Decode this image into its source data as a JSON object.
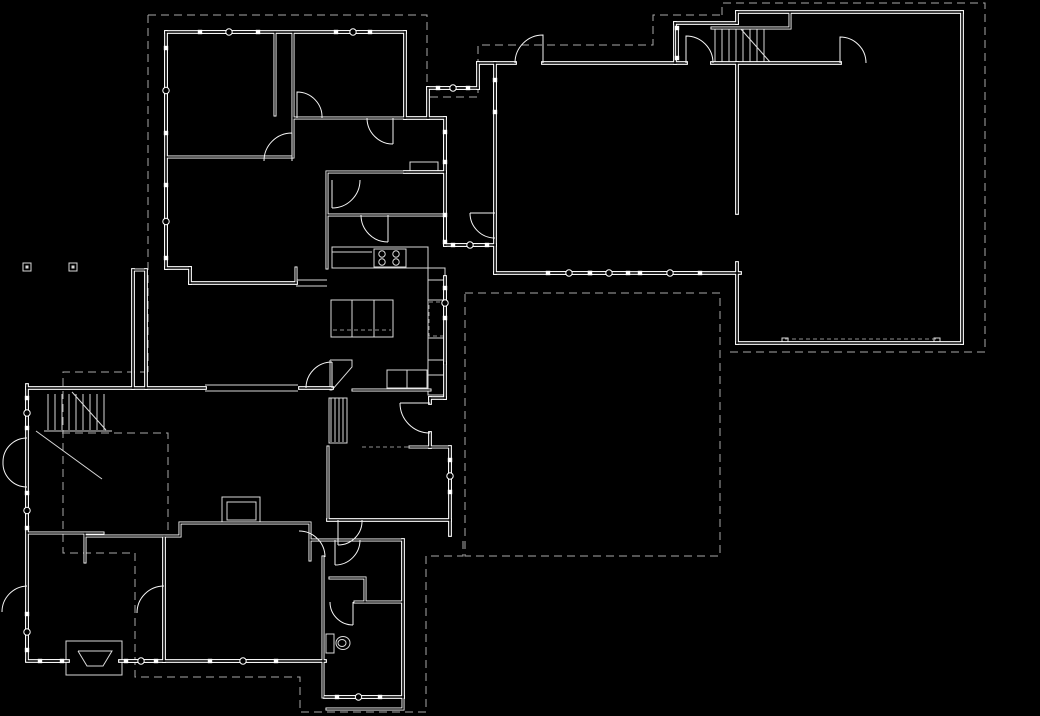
{
  "meta": {
    "canvas": {
      "w": 1040,
      "h": 716
    },
    "colors": {
      "background": "#000000",
      "wall": "#ffffff",
      "wall_core": "#000000",
      "thin": "#d9d9d9",
      "roof_dash": "#a8a8a8",
      "detail_dash": "#8f8f8f",
      "door": "#f5f5f5"
    },
    "drawing_type": "architectural-floor-plan"
  },
  "plan": {
    "walls_ext": [
      [
        166,
        32,
        405,
        32
      ],
      [
        166,
        32,
        166,
        268
      ],
      [
        405,
        32,
        405,
        118
      ],
      [
        405,
        118,
        445,
        118
      ],
      [
        445,
        118,
        445,
        245
      ],
      [
        405,
        172,
        445,
        172
      ],
      [
        445,
        245,
        495,
        245
      ],
      [
        495,
        63,
        495,
        273
      ],
      [
        478,
        63,
        515,
        63
      ],
      [
        543,
        63,
        686,
        63
      ],
      [
        712,
        63,
        840,
        63
      ],
      [
        478,
        63,
        478,
        88
      ],
      [
        428,
        88,
        478,
        88
      ],
      [
        428,
        88,
        428,
        118
      ],
      [
        495,
        273,
        740,
        273
      ],
      [
        737,
        63,
        737,
        213
      ],
      [
        737,
        263,
        737,
        343
      ],
      [
        737,
        12,
        962,
        12
      ],
      [
        962,
        12,
        962,
        343
      ],
      [
        737,
        343,
        962,
        343
      ],
      [
        675,
        23,
        737,
        23
      ],
      [
        675,
        23,
        675,
        63
      ],
      [
        737,
        12,
        737,
        23
      ],
      [
        166,
        268,
        190,
        268
      ],
      [
        190,
        268,
        190,
        283
      ],
      [
        190,
        283,
        296,
        283
      ],
      [
        27,
        388,
        205,
        388
      ],
      [
        300,
        388,
        332,
        388
      ],
      [
        27,
        385,
        27,
        660
      ],
      [
        27,
        661,
        68,
        661
      ],
      [
        120,
        661,
        164,
        661
      ],
      [
        164,
        661,
        325,
        661
      ],
      [
        164,
        538,
        164,
        661
      ],
      [
        325,
        697,
        403,
        697
      ],
      [
        403,
        540,
        403,
        697
      ],
      [
        430,
        433,
        430,
        447
      ],
      [
        450,
        447,
        450,
        535
      ],
      [
        328,
        520,
        450,
        520
      ],
      [
        445,
        277,
        445,
        363
      ],
      [
        445,
        363,
        445,
        398
      ],
      [
        430,
        398,
        445,
        398
      ],
      [
        430,
        398,
        430,
        403
      ],
      [
        133,
        270,
        133,
        388
      ],
      [
        146,
        270,
        146,
        388
      ]
    ],
    "walls_int": [
      [
        275,
        32,
        275,
        115
      ],
      [
        293,
        32,
        293,
        157
      ],
      [
        166,
        157,
        293,
        157
      ],
      [
        293,
        118,
        405,
        118
      ],
      [
        327,
        172,
        405,
        172
      ],
      [
        327,
        172,
        327,
        268
      ],
      [
        327,
        215,
        445,
        215
      ],
      [
        296,
        268,
        296,
        283
      ],
      [
        712,
        28,
        790,
        28
      ],
      [
        790,
        13,
        790,
        28
      ],
      [
        27,
        533,
        103,
        533
      ],
      [
        85,
        533,
        85,
        562
      ],
      [
        85,
        536,
        164,
        536
      ],
      [
        164,
        536,
        180,
        536
      ],
      [
        180,
        523,
        180,
        536
      ],
      [
        180,
        523,
        310,
        523
      ],
      [
        310,
        523,
        310,
        560
      ],
      [
        323,
        557,
        323,
        697
      ],
      [
        310,
        540,
        403,
        540
      ],
      [
        330,
        578,
        365,
        578
      ],
      [
        365,
        578,
        365,
        602
      ],
      [
        355,
        602,
        403,
        602
      ],
      [
        327,
        709,
        403,
        709
      ],
      [
        403,
        697,
        403,
        709
      ],
      [
        353,
        390,
        430,
        390
      ],
      [
        410,
        447,
        450,
        447
      ],
      [
        328,
        447,
        328,
        520
      ],
      [
        133,
        270,
        146,
        270
      ]
    ],
    "windows": [
      {
        "s": [
          200,
          32,
          258,
          32
        ],
        "c": true
      },
      {
        "s": [
          336,
          32,
          370,
          32
        ],
        "c": true
      },
      {
        "s": [
          166,
          48,
          166,
          133
        ],
        "c": true
      },
      {
        "s": [
          166,
          185,
          166,
          258
        ],
        "c": true
      },
      {
        "s": [
          438,
          88,
          468,
          88
        ],
        "c": true
      },
      {
        "s": [
          445,
          132,
          445,
          162
        ],
        "c": false
      },
      {
        "s": [
          445,
          215,
          445,
          242
        ],
        "c": false
      },
      {
        "s": [
          453,
          245,
          487,
          245
        ],
        "c": true
      },
      {
        "s": [
          495,
          80,
          495,
          112
        ],
        "c": false
      },
      {
        "s": [
          548,
          273,
          590,
          273
        ],
        "c": true
      },
      {
        "s": [
          590,
          273,
          628,
          273
        ],
        "c": true
      },
      {
        "s": [
          640,
          273,
          700,
          273
        ],
        "c": true
      },
      {
        "s": [
          445,
          288,
          445,
          318
        ],
        "c": true
      },
      {
        "s": [
          450,
          460,
          450,
          492
        ],
        "c": true
      },
      {
        "s": [
          27,
          398,
          27,
          428
        ],
        "c": true
      },
      {
        "s": [
          27,
          493,
          27,
          528
        ],
        "c": true
      },
      {
        "s": [
          27,
          614,
          27,
          650
        ],
        "c": true
      },
      {
        "s": [
          40,
          661,
          62,
          661
        ],
        "c": false
      },
      {
        "s": [
          126,
          661,
          156,
          661
        ],
        "c": true
      },
      {
        "s": [
          210,
          661,
          276,
          661
        ],
        "c": true
      },
      {
        "s": [
          337,
          697,
          380,
          697
        ],
        "c": true
      },
      {
        "s": [
          677,
          28,
          677,
          58
        ],
        "c": false
      }
    ],
    "doors": [
      "M515,63 A28,28 0 0 1 543,35 L543,63",
      "M686,63 L686,36 A27,27 0 0 1 713,63",
      "M840,63 L840,37 A26,26 0 0 1 866,63",
      "M297,118 L297,92 A25,25 0 0 1 322,118",
      "M292,133 L292,161 M292,133 A28,28 0 0 0 264,161",
      "M332,180 L332,208 M332,208 A28,28 0 0 0 360,180",
      "M388,215 L388,242 M388,242 A27,27 0 0 1 361,215",
      "M430,403 L400,403 M400,403 A30,30 0 0 0 430,433",
      "M338,520 L338,545 M362,520 A24,24 0 0 1 338,545",
      "M27,438 A24,24 0 0 0 3,462",
      "M27,487 A24,24 0 0 1 3,462",
      "M27,586 A26,26 0 0 0 2,612",
      "M164,586 A27,27 0 0 0 137,613",
      "M353,602 L353,625 M330,602 A23,23 0 0 0 353,625",
      "M299,531 A26,26 0 0 1 325,557",
      "M495,213 L470,213 M470,213 A25,25 0 0 0 495,238",
      "M332,388 L332,362 M306,388 A26,26 0 0 1 332,362",
      "M393,118 L393,144 M393,144 A26,26 0 0 1 367,118",
      "M335,540 L335,565 M360,540 A25,25 0 0 1 335,565"
    ],
    "dashed_roof": [
      [
        [
          148,
          15
        ],
        [
          427,
          15
        ],
        [
          427,
          97
        ],
        [
          478,
          97
        ],
        [
          478,
          45
        ],
        [
          653,
          45
        ],
        [
          653,
          15
        ],
        [
          722,
          15
        ]
      ],
      [
        [
          722,
          15
        ],
        [
          722,
          3
        ],
        [
          985,
          3
        ],
        [
          985,
          352
        ],
        [
          730,
          352
        ]
      ],
      [
        [
          148,
          15
        ],
        [
          148,
          372
        ]
      ],
      [
        [
          148,
          372
        ],
        [
          63,
          372
        ],
        [
          63,
          553
        ],
        [
          135,
          553
        ],
        [
          135,
          677
        ],
        [
          300,
          677
        ],
        [
          300,
          712
        ],
        [
          426,
          712
        ],
        [
          426,
          556
        ],
        [
          463,
          556
        ],
        [
          463,
          540
        ]
      ],
      [
        [
          465,
          293
        ],
        [
          720,
          293
        ],
        [
          720,
          556
        ],
        [
          465,
          556
        ],
        [
          465,
          293
        ]
      ],
      [
        [
          62,
          433
        ],
        [
          168,
          433
        ],
        [
          168,
          530
        ]
      ]
    ],
    "dashed_detail": [
      [
        [
          429,
          302
        ],
        [
          444,
          302
        ],
        [
          444,
          336
        ],
        [
          429,
          336
        ],
        [
          429,
          302
        ]
      ],
      [
        [
          785,
          339
        ],
        [
          937,
          339
        ]
      ],
      [
        [
          362,
          447
        ],
        [
          408,
          447
        ]
      ],
      [
        [
          333,
          330
        ],
        [
          391,
          330
        ]
      ]
    ],
    "thin_lines": [
      [
        205,
        385,
        298,
        385
      ],
      [
        205,
        391,
        298,
        391
      ],
      [
        296,
        280,
        327,
        280
      ],
      [
        296,
        286,
        327,
        286
      ],
      [
        715,
        28,
        715,
        62
      ],
      [
        722,
        28,
        722,
        62
      ],
      [
        729,
        28,
        729,
        62
      ],
      [
        736,
        28,
        736,
        62
      ],
      [
        743,
        28,
        743,
        62
      ],
      [
        750,
        28,
        750,
        62
      ],
      [
        757,
        28,
        757,
        62
      ],
      [
        764,
        28,
        764,
        62
      ],
      [
        740,
        28,
        770,
        62
      ],
      [
        48,
        394,
        48,
        430
      ],
      [
        55,
        394,
        55,
        430
      ],
      [
        62,
        394,
        62,
        430
      ],
      [
        69,
        394,
        69,
        430
      ],
      [
        76,
        394,
        76,
        430
      ],
      [
        83,
        394,
        83,
        430
      ],
      [
        90,
        394,
        90,
        430
      ],
      [
        97,
        394,
        97,
        430
      ],
      [
        104,
        394,
        104,
        430
      ],
      [
        44,
        431,
        112,
        431
      ],
      [
        72,
        392,
        106,
        430
      ],
      [
        36,
        431,
        102,
        479
      ],
      [
        428,
        280,
        445,
        280
      ],
      [
        428,
        300,
        445,
        300
      ],
      [
        428,
        338,
        445,
        338
      ],
      [
        428,
        360,
        445,
        360
      ],
      [
        428,
        375,
        445,
        375
      ],
      [
        352,
        300,
        352,
        337
      ],
      [
        374,
        300,
        374,
        337
      ],
      [
        332,
        252,
        372,
        252
      ],
      [
        331,
        398,
        331,
        442
      ],
      [
        335,
        398,
        335,
        442
      ],
      [
        339,
        398,
        339,
        442
      ],
      [
        343,
        398,
        343,
        442
      ],
      [
        347,
        398,
        347,
        442
      ],
      [
        387,
        370,
        387,
        388
      ],
      [
        407,
        370,
        407,
        388
      ]
    ],
    "rects_thin": [
      [
        331,
        300,
        62,
        37
      ],
      [
        374,
        249,
        32,
        18
      ],
      [
        332,
        247,
        96,
        21
      ],
      [
        428,
        268,
        17,
        127
      ],
      [
        387,
        370,
        40,
        18
      ],
      [
        222,
        497,
        38,
        26
      ],
      [
        227,
        502,
        29,
        18
      ],
      [
        66,
        641,
        56,
        34
      ],
      [
        326,
        634,
        8,
        19
      ],
      [
        410,
        162,
        28,
        10
      ],
      [
        329,
        398,
        18,
        45
      ],
      [
        23,
        263,
        8,
        8
      ],
      [
        69,
        263,
        8,
        8
      ],
      [
        782,
        338,
        6,
        6
      ],
      [
        934,
        338,
        6,
        6
      ]
    ],
    "rects_filled": [
      [
        25.5,
        265.5,
        3,
        3
      ],
      [
        71.5,
        265.5,
        3,
        3
      ]
    ],
    "polylines_thin": [
      [
        [
          78,
          651
        ],
        [
          112,
          651
        ],
        [
          103,
          666
        ],
        [
          87,
          666
        ],
        [
          78,
          651
        ]
      ],
      [
        [
          330,
          360
        ],
        [
          352,
          360
        ],
        [
          352,
          367
        ],
        [
          332,
          390
        ],
        [
          330,
          390
        ],
        [
          330,
          360
        ]
      ]
    ],
    "circles": [
      {
        "cx": 382,
        "cy": 254,
        "r": 3.2
      },
      {
        "cx": 396,
        "cy": 254,
        "r": 3.2
      },
      {
        "cx": 382,
        "cy": 262,
        "r": 3.2
      },
      {
        "cx": 396,
        "cy": 262,
        "r": 3.2
      }
    ],
    "ellipses": [
      {
        "cx": 343,
        "cy": 643,
        "rx": 7,
        "ry": 6.5
      },
      {
        "cx": 342,
        "cy": 643,
        "rx": 4,
        "ry": 3.5
      }
    ]
  }
}
